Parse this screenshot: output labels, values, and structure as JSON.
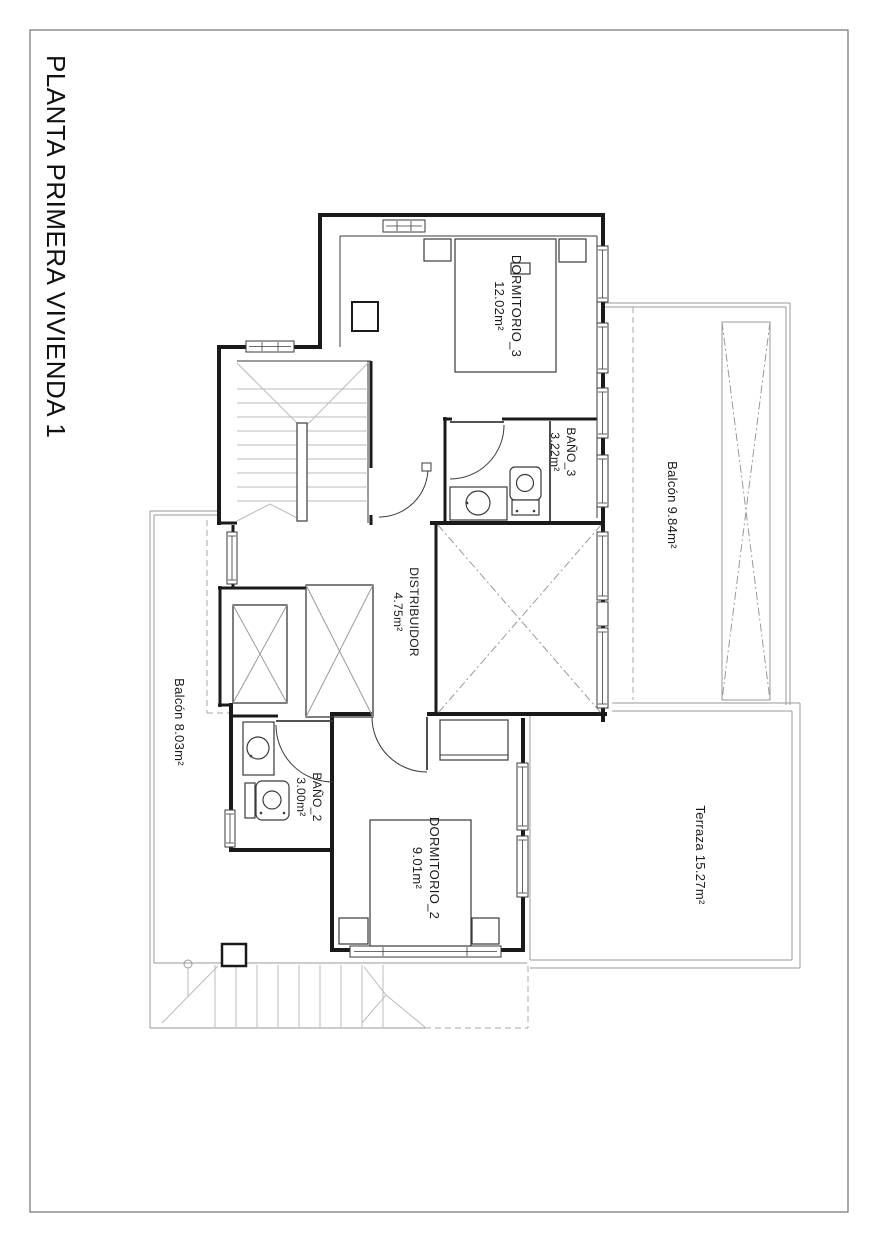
{
  "title": "PLANTA PRIMERA VIVIENDA 1",
  "rooms": {
    "dormitorio3": {
      "name": "DORMITORIO_3",
      "area": "12.02m²"
    },
    "bano3": {
      "name": "BAÑO_3",
      "area": "3.22m²"
    },
    "distribuidor": {
      "name": "DISTRIBUIDOR",
      "area": "4.75m²"
    },
    "bano2": {
      "name": "BAÑO_2",
      "area": "3.00m²"
    },
    "dormitorio2": {
      "name": "DORMITORIO_2",
      "area": "9.01m²"
    },
    "balcon_right": {
      "label": "Balcón 9.84m²"
    },
    "balcon_left": {
      "label": "Balcón 8.03m²"
    },
    "terraza": {
      "label": "Terraza 15.27m²"
    }
  },
  "colors": {
    "wall": "#1a1a1a",
    "fixture": "#3a3a3a",
    "light": "#9a9a9a",
    "text": "#1a1a1a"
  }
}
